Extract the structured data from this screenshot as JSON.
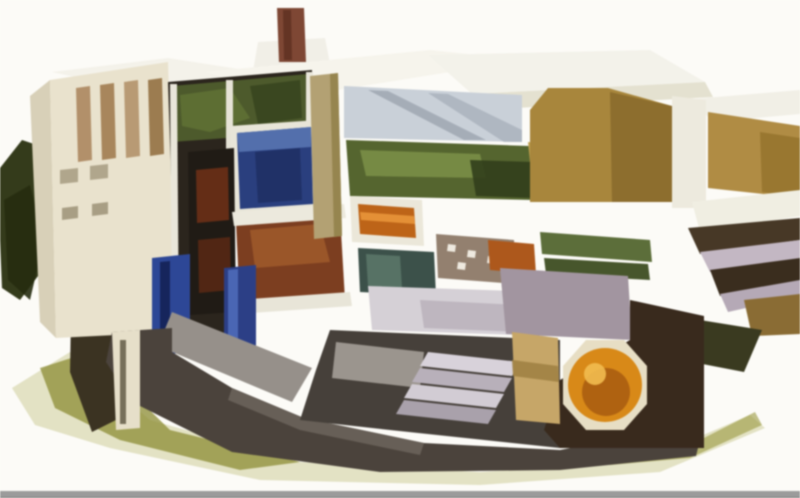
{
  "illustration": {
    "alt": "Isometric cutaway illustration of a nuclear power plant complex showing reactor building interior with blue spent fuel pool, reactor vessel, green turbine machinery, orange generator, cream and tan buildings with white roofs, dark foundation and olive ground shadow, vent stack on top, dark green trees at left, on a white background with a gray bar along the bottom edge",
    "background_color": "#fcfbf7",
    "bottom_bar_color": "#9b9b9b",
    "palette": {
      "cream_wall": "#e9e2cd",
      "white_roof": "#f4f2ea",
      "tan_wall": "#a8863c",
      "interior_dark": "#2b251d",
      "pool_blue": "#2a3f7e",
      "machinery_green": "#55652f",
      "machinery_redbrown": "#7c3e20",
      "generator_orange": "#d88918",
      "foliage_dark": "#343b1b",
      "ground_olive": "#8c8c34",
      "foundation_dark": "#4b433c"
    },
    "shapes": [
      {
        "name": "ground-halo",
        "fill": "#c9ca92",
        "opacity": 0.5,
        "points": "12,388 70,352 150,420 300,462 480,472 640,462 750,415 765,428 660,472 480,485 260,480 110,448 35,425"
      },
      {
        "name": "ground-shadow-left",
        "fill": "#8c8c34",
        "opacity": 0.75,
        "points": "40,368 90,352 170,430 300,462 240,470 120,440 55,408"
      },
      {
        "name": "ground-shadow-right",
        "fill": "#9a9a40",
        "opacity": 0.6,
        "points": "600,455 700,440 755,412 762,425 690,458 610,465"
      },
      {
        "name": "trees-left",
        "fill": "#343b1b",
        "points": "0,168 22,140 46,148 52,205 44,268 20,300 2,288 0,240"
      },
      {
        "name": "trees-left-dark",
        "fill": "#262c10",
        "opacity": 0.9,
        "points": "4,200 30,185 44,240 30,300 8,280"
      },
      {
        "name": "trees-left-lower",
        "fill": "#3b3322",
        "points": "72,262 112,256 116,420 92,432 70,372"
      },
      {
        "name": "roof-left",
        "fill": "#f4f2ea",
        "points": "52,72 168,58 310,80 165,97"
      },
      {
        "name": "vent-stack-frame",
        "fill": "#f1efe7",
        "points": "258,42 325,38 332,74 252,77"
      },
      {
        "name": "vent-stack",
        "fill": "#7e4734",
        "points": "277,8 304,8 306,62 279,62"
      },
      {
        "name": "vent-stack-shadow",
        "fill": "#5e3020",
        "opacity": 0.8,
        "points": "283,10 291,10 292,60 284,60"
      },
      {
        "name": "roof-center",
        "fill": "#f6f4ec",
        "points": "205,72 430,50 525,60 300,96"
      },
      {
        "name": "roof-turbine-hall",
        "fill": "#f3f2ea",
        "points": "428,55 650,50 705,82 472,94"
      },
      {
        "name": "roof-turbine-edge",
        "fill": "#e4e1d0",
        "points": "472,94 705,82 713,97 480,110"
      },
      {
        "name": "roof-right-building",
        "fill": "#f1efe6",
        "points": "693,99 800,90 800,114 712,122"
      },
      {
        "name": "aux-building-side",
        "fill": "#d8d0b8",
        "points": "30,96 50,80 56,338 40,322"
      },
      {
        "name": "aux-building-front",
        "fill": "#e9e2cd",
        "points": "50,80 168,62 176,332 56,338"
      },
      {
        "name": "aux-window-strip-1",
        "fill": "#b2906a",
        "points": "76,88 90,86 92,160 78,162"
      },
      {
        "name": "aux-window-strip-2",
        "fill": "#a8865c",
        "points": "100,85 114,83 116,158 102,160"
      },
      {
        "name": "aux-window-strip-3",
        "fill": "#b89a74",
        "points": "124,82 138,80 140,156 126,158"
      },
      {
        "name": "aux-window-strip-4",
        "fill": "#9c7c50",
        "points": "148,80 162,78 164,154 150,156"
      },
      {
        "name": "aux-window-a",
        "fill": "#b0a68c",
        "points": "60,170 78,168 78,182 60,184"
      },
      {
        "name": "aux-window-b",
        "fill": "#b0a68c",
        "points": "90,166 108,164 108,178 90,180"
      },
      {
        "name": "aux-window-c",
        "fill": "#a89e84",
        "points": "62,208 78,206 78,218 62,220"
      },
      {
        "name": "aux-window-d",
        "fill": "#a89e84",
        "points": "92,204 108,202 108,214 92,216"
      },
      {
        "name": "reactor-interior-cut",
        "fill": "#2b251d",
        "points": "168,82 312,70 312,208 232,214 232,338 176,334"
      },
      {
        "name": "interior-equipment-green",
        "fill": "#4d5a2c",
        "points": "172,86 308,74 308,132 172,142"
      },
      {
        "name": "interior-green-highlight",
        "fill": "#5f7034",
        "opacity": 0.9,
        "points": "180,95 230,88 250,118 210,132 182,126"
      },
      {
        "name": "interior-green-dark",
        "fill": "#39451f",
        "opacity": 0.9,
        "points": "250,86 300,80 302,118 258,124"
      },
      {
        "name": "interior-column-1",
        "fill": "#e9e6da",
        "points": "170,84 177,84 179,334 172,334"
      },
      {
        "name": "interior-column-2",
        "fill": "#e6e3d6",
        "points": "226,80 233,80 233,214 226,214"
      },
      {
        "name": "interior-column-3",
        "fill": "#eae7db",
        "points": "306,72 313,72 313,210 306,210"
      },
      {
        "name": "fuel-pool-frame",
        "fill": "#e8e5d8",
        "points": "230,126 318,120 320,212 234,217"
      },
      {
        "name": "fuel-pool-water",
        "fill": "#2a3f7e",
        "points": "237,133 311,127 313,204 240,209"
      },
      {
        "name": "fuel-pool-surface",
        "fill": "#5a78b4",
        "opacity": 0.85,
        "points": "237,133 311,127 311,147 239,152"
      },
      {
        "name": "fuel-pool-deep",
        "fill": "#1c2c5e",
        "opacity": 0.7,
        "points": "255,152 300,148 302,200 258,203"
      },
      {
        "name": "reactor-vessel",
        "fill": "#201b15",
        "points": "188,152 234,148 236,312 190,315"
      },
      {
        "name": "reactor-internals-upper",
        "fill": "#6b3016",
        "opacity": 0.9,
        "points": "196,170 228,167 229,220 197,223"
      },
      {
        "name": "reactor-internals-lower",
        "fill": "#572814",
        "opacity": 0.9,
        "points": "198,240 230,237 231,290 199,293"
      },
      {
        "name": "drywell-machinery",
        "fill": "#7c3e20",
        "points": "236,222 340,214 345,300 240,308"
      },
      {
        "name": "drywell-machinery-light",
        "fill": "#a05a2c",
        "opacity": 0.85,
        "points": "250,230 320,224 330,262 255,268"
      },
      {
        "name": "floor-slab-upper",
        "fill": "#ece9dd",
        "points": "232,212 344,204 346,218 234,226"
      },
      {
        "name": "floor-slab-lower",
        "fill": "#e8e5d8",
        "points": "236,300 350,292 352,306 238,314"
      },
      {
        "name": "blue-pipes-left",
        "fill": "#2d4796",
        "points": "152,258 190,254 190,352 152,356"
      },
      {
        "name": "blue-pipes-left-dark",
        "fill": "#16255c",
        "points": "160,262 170,261 170,350 160,351"
      },
      {
        "name": "blue-pipes-right",
        "fill": "#2c3f86",
        "points": "224,268 256,265 256,348 224,351"
      },
      {
        "name": "blue-pipes-highlight",
        "fill": "#4a66b4",
        "points": "228,270 238,269 238,346 228,347"
      },
      {
        "name": "containment-wall-tan",
        "fill": "#b3a173",
        "points": "310,76 338,73 342,236 314,239"
      },
      {
        "name": "containment-wall-shade",
        "fill": "#96854f",
        "points": "330,74 338,73 342,236 334,237"
      },
      {
        "name": "crane-deck",
        "fill": "#c9d0d8",
        "points": "344,86 522,95 522,142 344,138"
      },
      {
        "name": "crane-rail-stripe",
        "fill": "#8d96a2",
        "opacity": 0.6,
        "points": "368,90 388,91 486,140 464,140"
      },
      {
        "name": "crane-rail-stripe-2",
        "fill": "#99a2ae",
        "opacity": 0.55,
        "points": "428,93 448,94 522,130 522,142 504,142"
      },
      {
        "name": "turbine-machinery-green",
        "fill": "#55652f",
        "points": "346,140 530,146 534,200 350,196"
      },
      {
        "name": "turbine-green-light",
        "fill": "#7d9048",
        "opacity": 0.85,
        "points": "360,150 480,154 486,178 366,176"
      },
      {
        "name": "turbine-green-dark",
        "fill": "#323e1c",
        "opacity": 0.9,
        "points": "470,160 532,162 534,198 476,196"
      },
      {
        "name": "steam-equipment-frame",
        "fill": "#ebe7d9",
        "points": "350,196 422,200 424,246 352,242"
      },
      {
        "name": "steam-equipment-orange",
        "fill": "#bd6418",
        "points": "358,204 414,208 416,238 360,234"
      },
      {
        "name": "steam-equipment-stripe",
        "fill": "#e8953a",
        "opacity": 0.9,
        "points": "360,212 414,216 415,224 361,220"
      },
      {
        "name": "condenser-teal",
        "fill": "#3c514a",
        "points": "358,248 434,252 436,296 360,292"
      },
      {
        "name": "condenser-teal-light",
        "fill": "#5e7a6c",
        "opacity": 0.8,
        "points": "366,254 400,256 402,288 368,286"
      },
      {
        "name": "pipe-gallery",
        "fill": "#93806f",
        "points": "436,234 514,240 516,284 438,278"
      },
      {
        "name": "pipe-gallery-dot-a",
        "fill": "#eee9df",
        "points": "448,244 456,245 455,252 447,251"
      },
      {
        "name": "pipe-gallery-dot-b",
        "fill": "#eee9df",
        "points": "468,250 476,251 475,258 467,257"
      },
      {
        "name": "pipe-gallery-dot-c",
        "fill": "#eee9df",
        "points": "488,256 496,257 495,264 487,263"
      },
      {
        "name": "pipe-gallery-dot-d",
        "fill": "#eee9df",
        "points": "458,262 466,263 465,270 457,269"
      },
      {
        "name": "orange-equipment",
        "fill": "#ad581c",
        "points": "488,240 534,244 536,274 490,270"
      },
      {
        "name": "hall-floor",
        "fill": "#d5d0d6",
        "points": "368,286 546,292 548,336 372,330"
      },
      {
        "name": "hall-floor-shade",
        "fill": "#b3abb5",
        "opacity": 0.7,
        "points": "420,300 520,305 522,332 424,328"
      },
      {
        "name": "feedwater-heaters",
        "fill": "#5c6e3a",
        "points": "540,232 650,240 652,262 542,254"
      },
      {
        "name": "feedwater-heaters-2",
        "fill": "#47562c",
        "points": "544,258 648,264 650,280 546,274"
      },
      {
        "name": "gold-piping",
        "fill": "#bfa050",
        "points": "528,142 582,148 584,168 530,162"
      },
      {
        "name": "turbine-building-wall",
        "fill": "#a8863c",
        "points": "530,110 548,88 608,88 672,106 672,202 530,202"
      },
      {
        "name": "turbine-building-wall-dark",
        "fill": "#8a6c2c",
        "opacity": 0.9,
        "points": "610,92 672,106 672,202 612,202"
      },
      {
        "name": "gable-white",
        "fill": "#edeade",
        "points": "672,96 706,100 706,208 672,208"
      },
      {
        "name": "right-building-wall",
        "fill": "#b08c44",
        "points": "708,112 800,126 800,198 708,188"
      },
      {
        "name": "right-building-wall-dark",
        "fill": "#97742f",
        "opacity": 0.9,
        "points": "760,132 800,138 800,198 762,192"
      },
      {
        "name": "right-roof-band",
        "fill": "#f0eee2",
        "points": "692,202 800,190 800,216 700,232"
      },
      {
        "name": "pipe-bridge-dark",
        "fill": "#473826",
        "points": "688,228 800,218 800,240 700,254"
      },
      {
        "name": "pipe-bridge-light",
        "fill": "#c3b7c3",
        "points": "700,252 800,240 800,258 710,272"
      },
      {
        "name": "pipe-bridge-dark-2",
        "fill": "#3a2d1e",
        "points": "710,270 800,258 800,282 720,296"
      },
      {
        "name": "pipe-bridge-light-2",
        "fill": "#b5a9b6",
        "points": "720,294 800,280 800,296 728,312"
      },
      {
        "name": "right-lower-wall",
        "fill": "#8a6c34",
        "points": "744,300 800,294 800,334 752,336"
      },
      {
        "name": "right-shrub",
        "fill": "#3a3a20",
        "points": "700,320 762,330 744,372 692,362"
      },
      {
        "name": "foundation-slope",
        "fill": "#96908a",
        "points": "172,312 312,368 292,402 158,346"
      },
      {
        "name": "foundation-mass",
        "fill": "#4b433c",
        "points": "112,332 172,328 172,352 232,388 304,418 424,443 560,450 622,438 700,440 696,456 560,470 380,472 232,452 132,402 106,362"
      },
      {
        "name": "foundation-edge-light",
        "fill": "#6e665e",
        "opacity": 0.8,
        "points": "232,388 304,418 424,443 420,455 300,430 228,400"
      },
      {
        "name": "basement-dark",
        "fill": "#46403a",
        "points": "330,330 560,340 560,448 390,430 300,420 316,370"
      },
      {
        "name": "foundation-parapet",
        "fill": "#aaa49e",
        "opacity": 0.85,
        "points": "336,342 424,352 420,388 332,378"
      },
      {
        "name": "aux-basement-column",
        "fill": "#e6dfc9",
        "points": "112,332 140,330 140,428 116,430"
      },
      {
        "name": "aux-basement-ladder",
        "fill": "#5a523f",
        "opacity": 0.8,
        "points": "120,340 126,340 126,424 120,424"
      },
      {
        "name": "heater-bay-floor",
        "fill": "#a295a0",
        "points": "500,268 628,276 632,340 506,334"
      },
      {
        "name": "generator-room-walls",
        "fill": "#392a1d",
        "points": "630,300 704,316 704,448 560,448 544,430 560,380 630,340"
      },
      {
        "name": "stairs-step-1",
        "fill": "#d8d2da",
        "points": "428,352 520,362 512,376 420,366"
      },
      {
        "name": "stairs-step-2",
        "fill": "#b8b0ba",
        "points": "420,368 512,378 504,392 412,382"
      },
      {
        "name": "stairs-step-3",
        "fill": "#d2ccd4",
        "points": "412,384 504,394 496,408 404,398"
      },
      {
        "name": "stairs-step-4",
        "fill": "#a9a1ab",
        "points": "404,400 496,410 488,424 396,414"
      },
      {
        "name": "turbine-casing-tan",
        "fill": "#c6a668",
        "points": "512,332 558,338 560,424 516,420"
      },
      {
        "name": "turbine-casing-shade",
        "fill": "#a08244",
        "opacity": 0.9,
        "points": "512,360 558,366 559,382 513,376"
      },
      {
        "name": "generator-frame",
        "fill": "#e7dec4",
        "points": "647,366 647,404 624,430 586,430 563,404 563,366 586,340 624,340"
      },
      {
        "name": "generator-rotor",
        "fill": "#d88918",
        "cx": 605,
        "cy": 385,
        "r": 37
      },
      {
        "name": "generator-rotor-core",
        "fill": "#a85c10",
        "opacity": 0.85,
        "cx": 606,
        "cy": 392,
        "r": 24
      },
      {
        "name": "generator-highlight",
        "fill": "#f2bc50",
        "opacity": 0.9,
        "cx": 595,
        "cy": 374,
        "r": 11
      },
      {
        "name": "bottom-gray-bar",
        "fill": "#9b9b9b",
        "points": "0,491 800,491 800,498 0,498"
      },
      {
        "name": "bottom-gray-bar-edge",
        "fill": "#7c7c7c",
        "points": "0,497 800,497 800,498 0,498"
      }
    ]
  }
}
